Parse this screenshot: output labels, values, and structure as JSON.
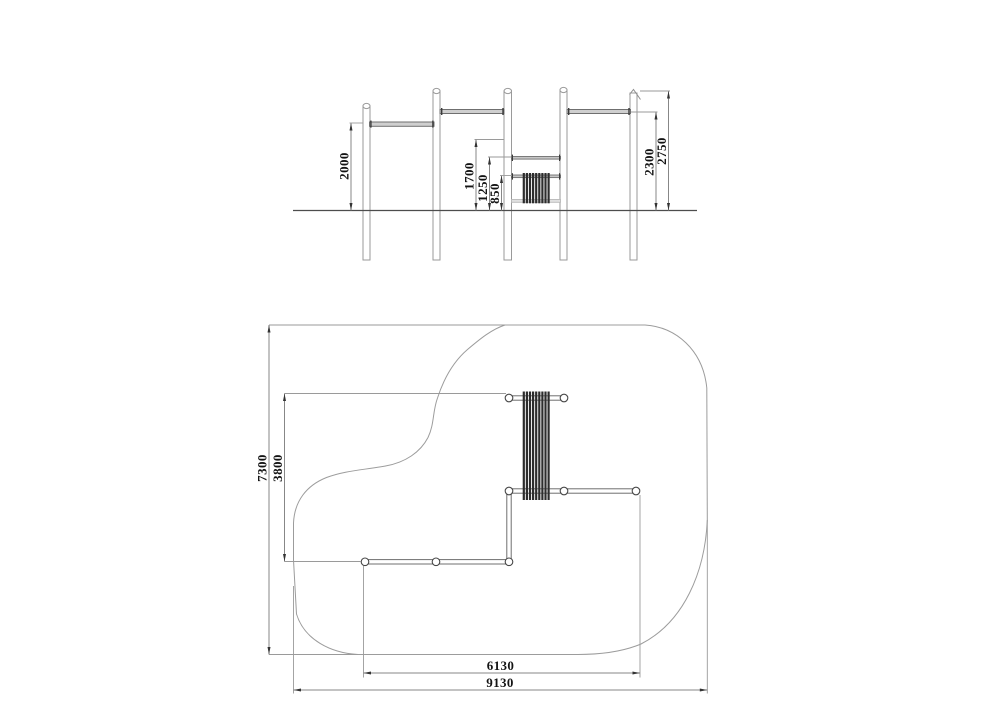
{
  "elevation": {
    "dims": {
      "d2000": "2000",
      "d1700": "1700",
      "d1250": "1250",
      "d850": "850",
      "d2300": "2300",
      "d2750": "2750"
    }
  },
  "plan": {
    "dims": {
      "d7300": "7300",
      "d3800": "3800",
      "d6130": "6130",
      "d9130": "9130"
    }
  },
  "colors": {
    "line": "#8f8f8f",
    "boundary": "#9c9c9c",
    "ground": "#4d4d4d",
    "dark_bars": "#2d2d2d",
    "text": "#141414"
  }
}
